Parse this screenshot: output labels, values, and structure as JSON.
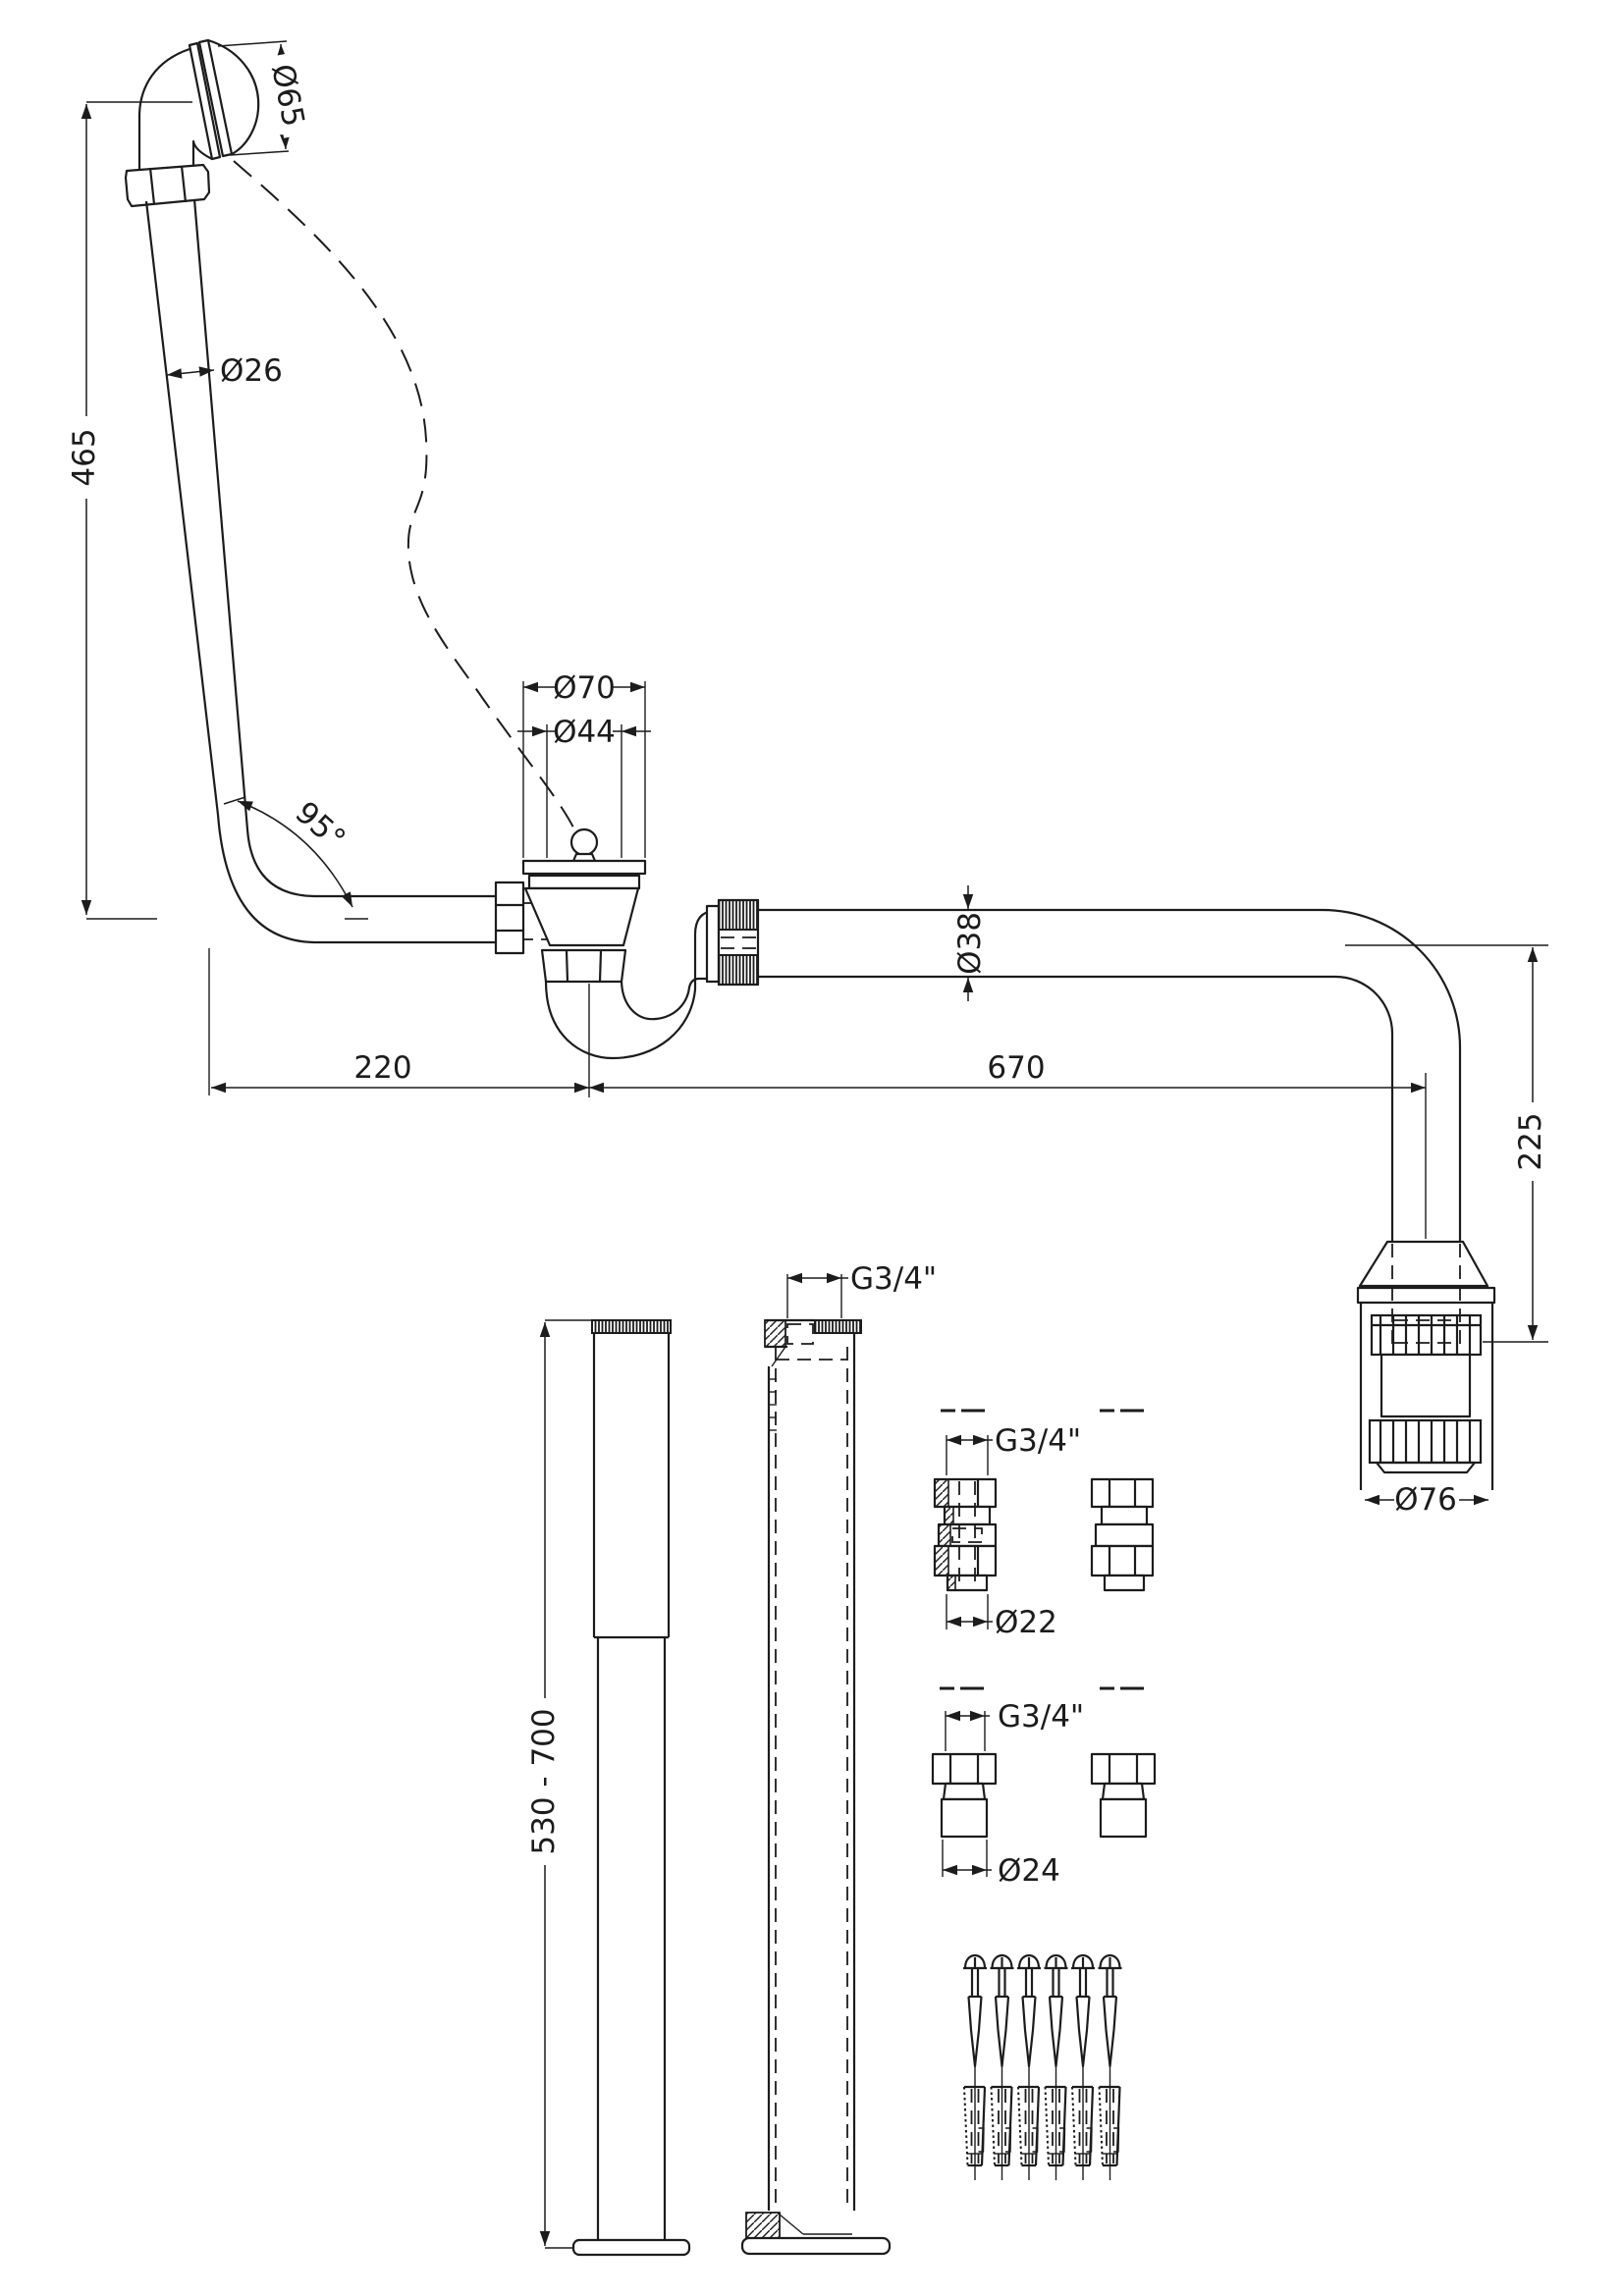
{
  "drawing": {
    "title": "bath-waste-overflow-kit-technical-drawing",
    "background": "#ffffff",
    "line_color": "#1c1c1c",
    "dimensions": {
      "overflow_face_diameter": "Ø65",
      "overflow_pipe_diameter": "Ø26",
      "overflow_height": "465",
      "bend_angle": "95°",
      "waste_flange_diameter": "Ø70",
      "waste_plug_diameter": "Ø44",
      "outlet_pipe_diameter": "Ø38",
      "trap_offset": "220",
      "pipe_run_length": "670",
      "drop_height": "225",
      "connector_diameter": "Ø76",
      "standpipe_thread": "G3/4\"",
      "standpipe_height_range": "530 - 700",
      "union_thread": "G3/4\"",
      "union_pipe_diameter": "Ø22",
      "adaptor_thread": "G3/4\"",
      "adaptor_diameter": "Ø24"
    },
    "hardware": {
      "screw_count": 6,
      "plug_count": 6
    }
  }
}
